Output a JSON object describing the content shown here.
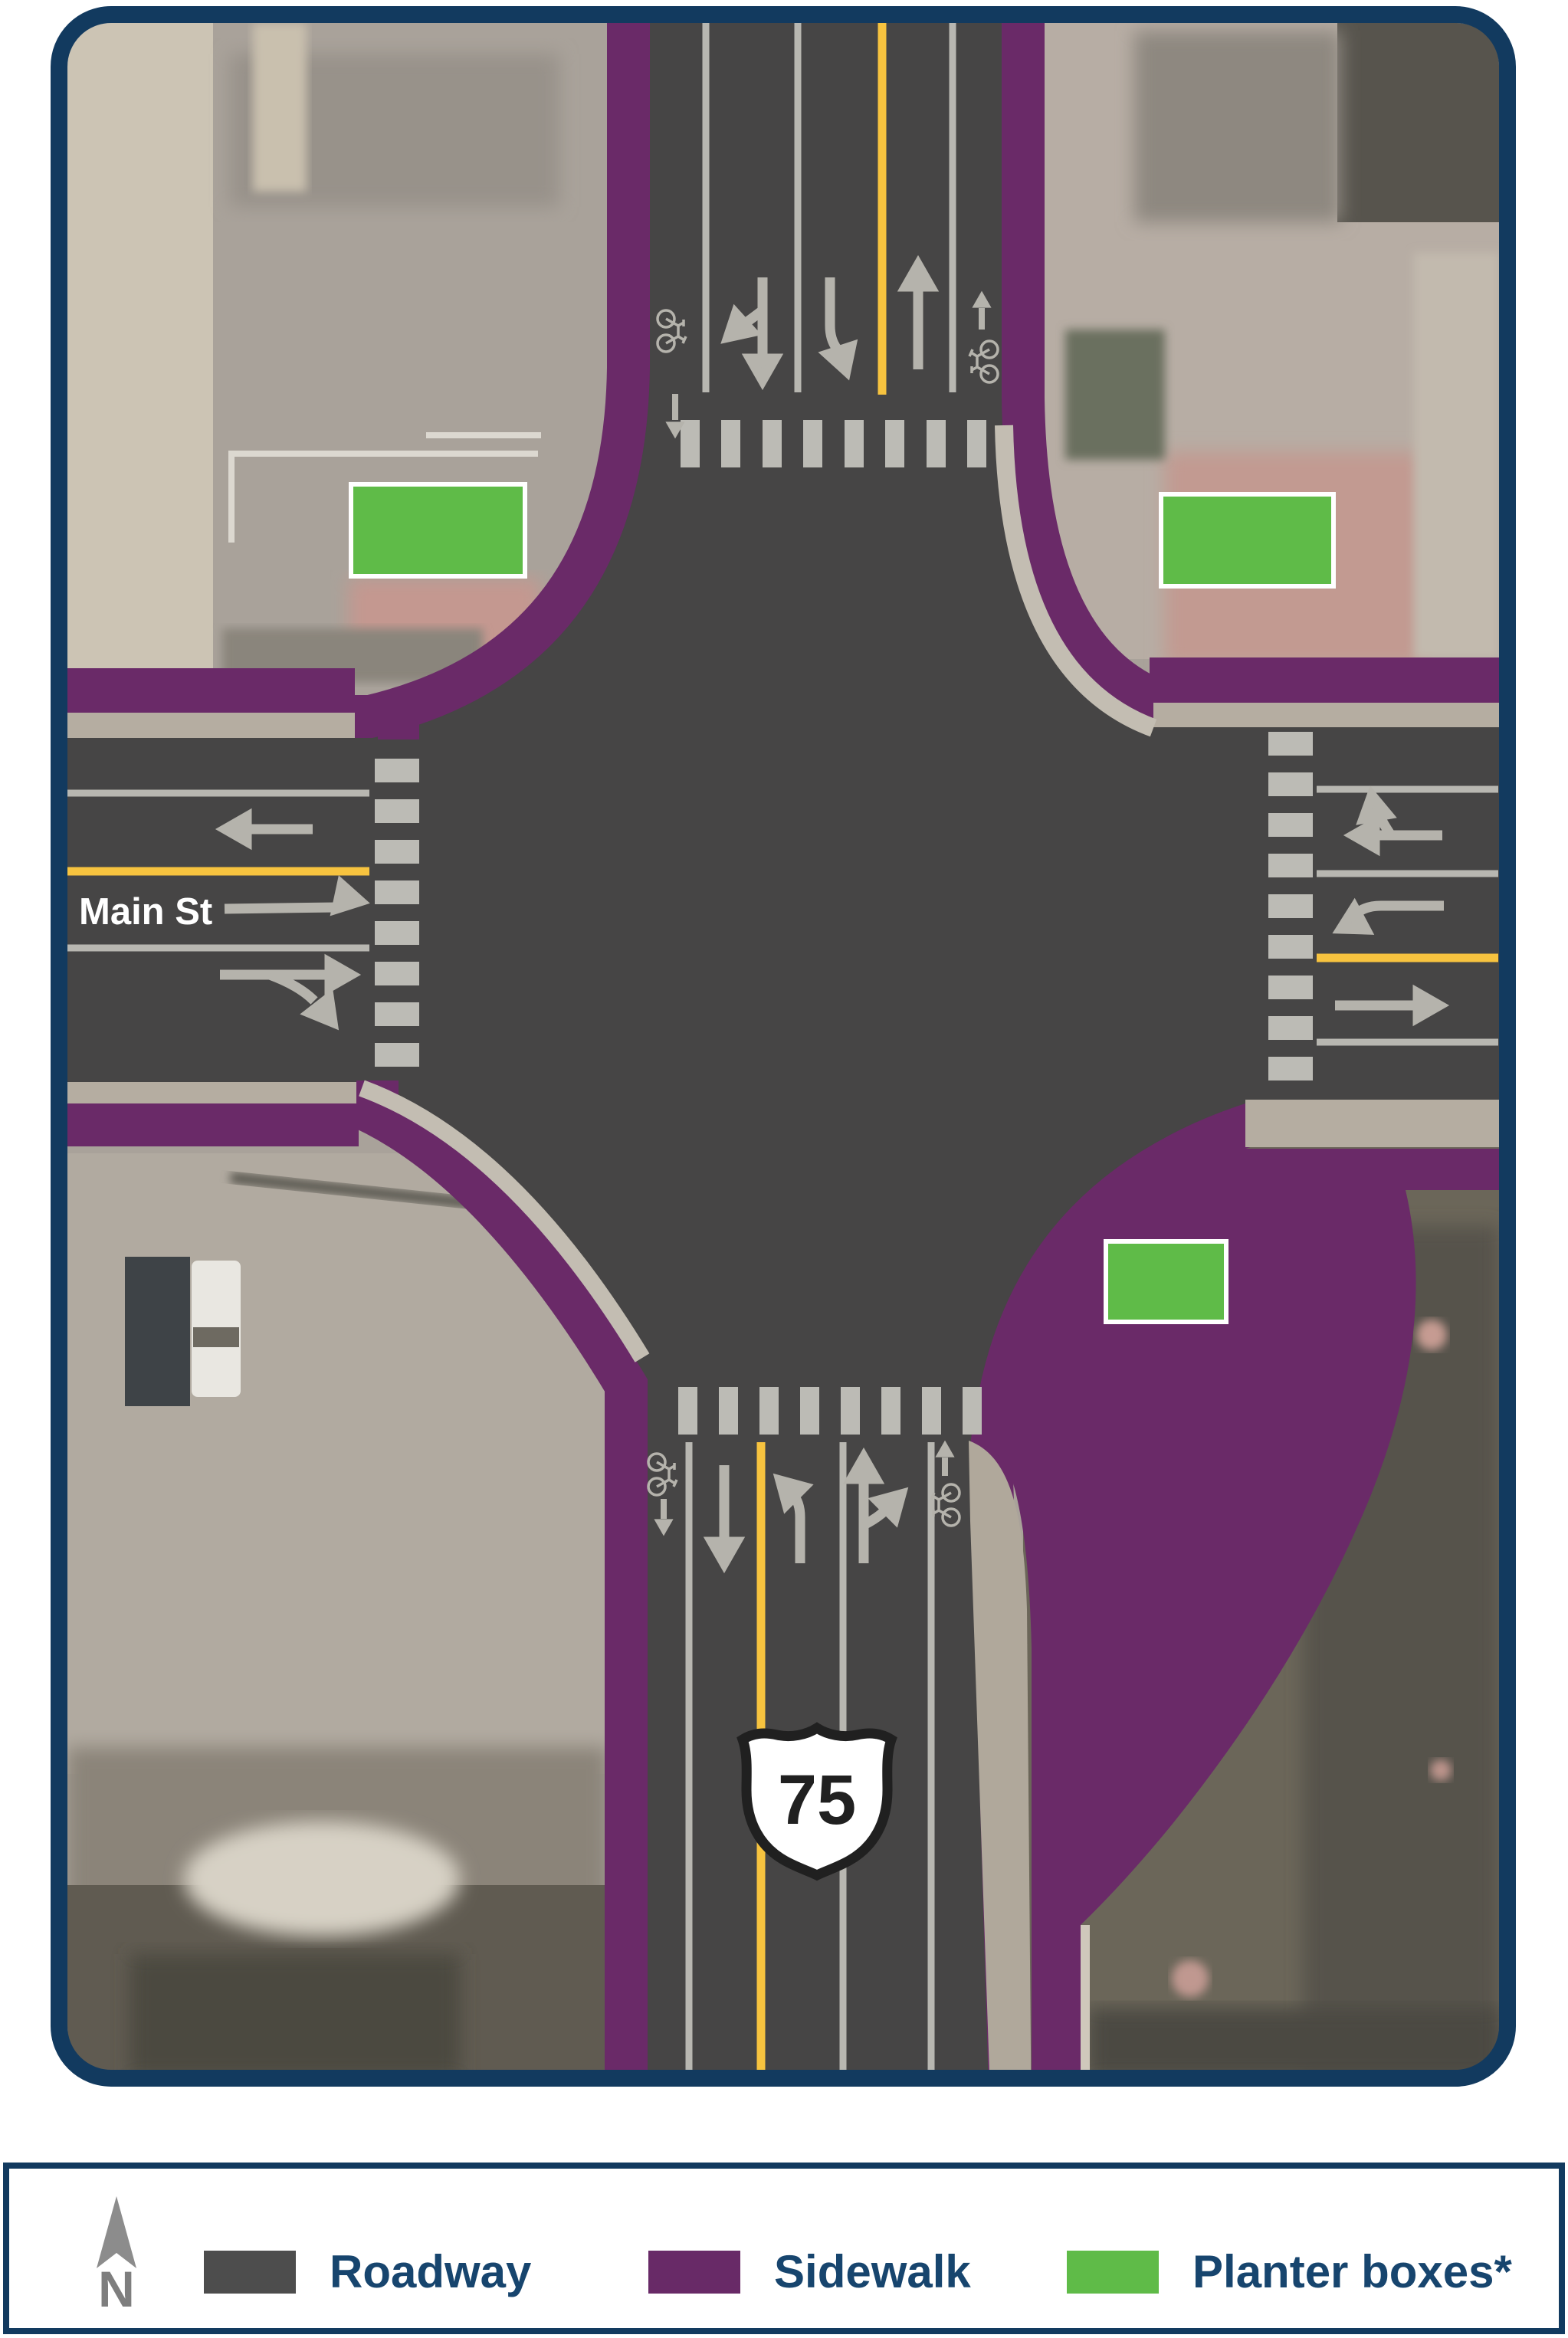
{
  "map": {
    "street_label": "Main St",
    "route_shield_number": "75",
    "icons": [
      "north-arrow-icon",
      "bicycle-icon",
      "lane-arrow-icon",
      "crosswalk-bars",
      "us-route-shield"
    ]
  },
  "legend": {
    "north_label": "N",
    "items": [
      {
        "label": "Roadway",
        "color": "#4D4D4D"
      },
      {
        "label": "Sidewalk",
        "color": "#682A67"
      },
      {
        "label": "Planter boxes*",
        "color": "#5FBB48"
      }
    ]
  },
  "theme": {
    "border_navy": "#123A5F",
    "text_navy": "#17456E",
    "roadway_gray": "#464545",
    "sidewalk_purple": "#6A2A68",
    "planter_green": "#5FBB48",
    "marking_gray": "#B5B3AC",
    "centerline_yellow": "#F7C33F"
  }
}
